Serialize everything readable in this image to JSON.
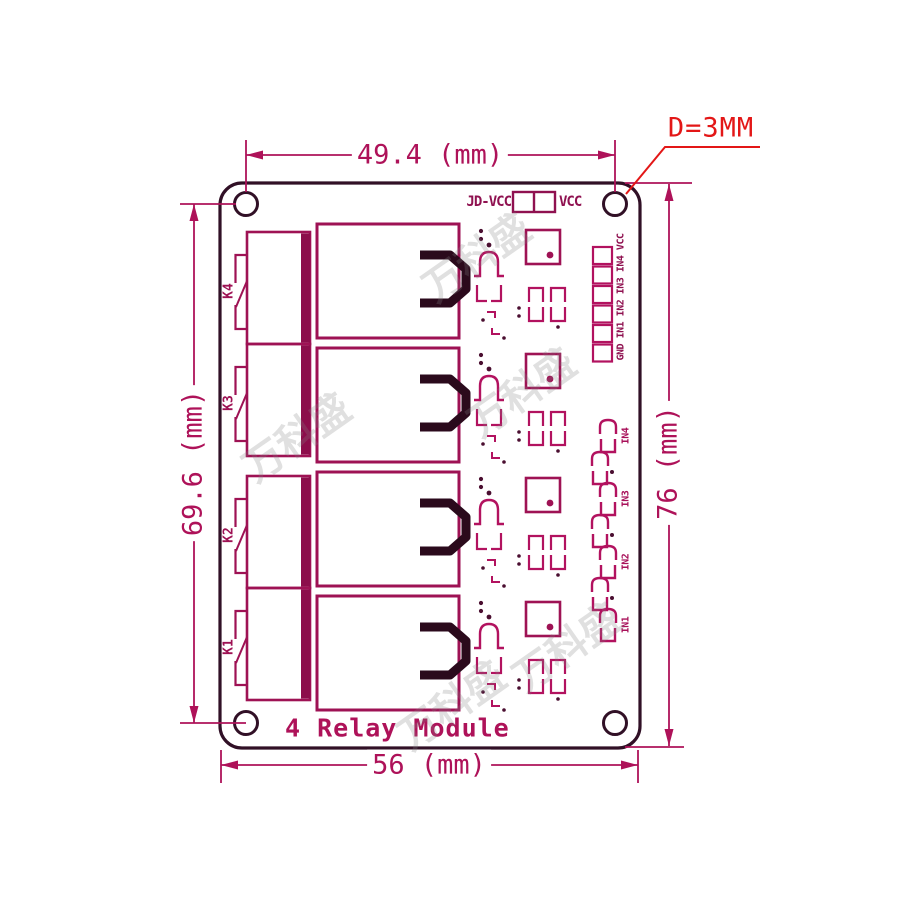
{
  "diagram": {
    "watermark": "万科盛",
    "colors": {
      "board_outline": "#311026",
      "copper_main": "#9e1254",
      "copper_light": "#b2125f",
      "copper_dark_fill": "#8c0e4b",
      "thick_trace": "#2b0a1c",
      "dimension": "#ae1259",
      "callout_red": "#e31717"
    }
  },
  "dimensions": {
    "top_width": "49.4 (mm)",
    "left_height": "69.6 (mm)",
    "right_height": "76 (mm)",
    "bottom_width": "56 (mm)",
    "hole_diameter": "D=3MM"
  },
  "board": {
    "title": "4 Relay Module",
    "jumper": {
      "left_label": "JD-VCC",
      "right_label": "VCC"
    },
    "header_label": "GND IN1 IN2 IN3 IN4 VCC",
    "terminals": [
      {
        "label": "K4"
      },
      {
        "label": "K3"
      },
      {
        "label": "K2"
      },
      {
        "label": "K1"
      }
    ],
    "inputs": [
      {
        "label": "IN4"
      },
      {
        "label": "IN3"
      },
      {
        "label": "IN2"
      },
      {
        "label": "IN1"
      }
    ]
  }
}
